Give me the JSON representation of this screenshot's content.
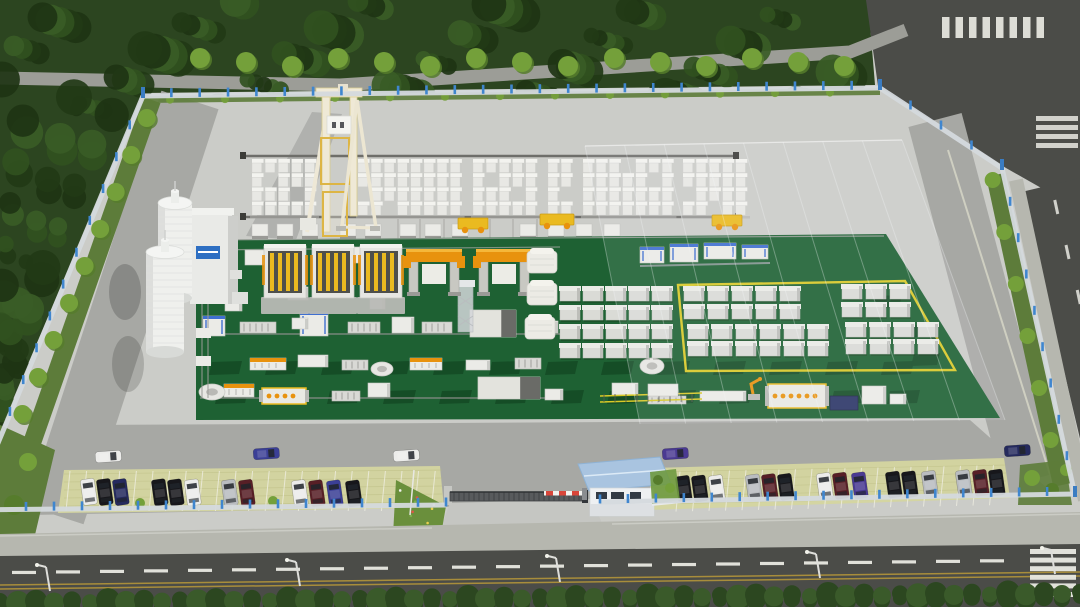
{
  "meta": {
    "scene_title": "Aerial 3D rendering of a precast concrete block factory compound",
    "view": "isometric aerial render",
    "image_size": "1080x607"
  },
  "palette": {
    "forest_base": "#2c4520",
    "canopy_1": "#223a16",
    "canopy_2": "#31511f",
    "canopy_3": "#3a5c26",
    "canopy_4": "#1e3413",
    "tree_bright": "#74a03a",
    "tree_dark": "#567c2c",
    "grass": "#5d7c3a",
    "path": "#9c9d97",
    "asphalt": "#4b4c48",
    "sidewalk": "#b6b7af",
    "pavement": "#cbccc8",
    "pavement_dark": "#a7a8a4",
    "driveway": "#c5c6c2",
    "green_floor": "#1e6133",
    "green_pit": "#154c26",
    "floor_yellow": "#d9c926",
    "fence_panel": "#d5dade",
    "fence_post": "#3f86cf",
    "block_white": "#e8e8e4",
    "block_top": "#f3f3ef",
    "block_shade": "#c3c4c0",
    "machine_white": "#ebebe7",
    "machine_gray": "#b8b9b5",
    "machine_dark": "#4e4f4b",
    "machine_orange": "#e8920e",
    "machine_yellow": "#eaba20",
    "machine_blue": "#3f6fd0",
    "navy_box": "#2b3566",
    "crane_cream": "#eee8d6",
    "crane_yellow": "#ddb544",
    "silo_white": "#eff0ed",
    "silo_shade": "#d8dad7",
    "sign_blue": "#2e6fc2",
    "roof_blue": "#a9c4e0",
    "house_wall": "#eef0f2",
    "paving_yellow": "#d4d5a0",
    "paving_grid": "#b8b97e",
    "hedge_1": "#2c4720",
    "hedge_2": "#3a5a2a",
    "marking_white": "#e9e9e3",
    "marking_yellow": "#b2953a",
    "car_white": "#ececea",
    "car_black": "#17171b",
    "car_silver": "#b9bcc0",
    "car_darkred": "#571f26",
    "car_blue": "#3b3f96",
    "car_navy": "#252a5e",
    "car_purple": "#4a3a92"
  },
  "labels": {
    "surroundings": "Dense tree belt on north and west, service path behind trees, road intersection with zebra crossings at top right, street along east fence, four-lane street with dashed lane line and double yellow centerline along the south, clipped hedge row at bottom edge",
    "compound": "Walled compound with light panel fence on blue posts, concrete hardstanding, block storage yard under a beige gantry crane, two white silos with batching building, dark-green coated production floor with casting machines, demolding gantries, conveyor lines and pallet stacks, translucent warehouse outline over the east half, yellow painted floor marking, grass-grid parking along the south fence, sliding entrance gate with boom barrier and blue-roofed guard house"
  },
  "inventory": {
    "silos": 2,
    "casting_machines": 3,
    "demolding_gantries": 2,
    "curing_tents": 3,
    "block_storage_clusters": 6,
    "pallet_stack_groups": 5,
    "transfer_carts": 3,
    "conveyor_lines": 3,
    "robot_arms": 1,
    "street_lamps": 5,
    "moving_cars": 5,
    "parked_cars": 27,
    "guard_houses": 1
  },
  "block_clusters": [
    {
      "x": 252,
      "cols": 5
    },
    {
      "x": 358,
      "cols": 8
    },
    {
      "x": 473,
      "cols": 5
    },
    {
      "x": 548,
      "cols": 2
    },
    {
      "x": 583,
      "cols": 7
    },
    {
      "x": 683,
      "cols": 5
    }
  ],
  "pallet_groups": [
    {
      "x0": 560,
      "y0": 288,
      "cols": 5,
      "rows": 4,
      "dx": 23,
      "dy": 19
    },
    {
      "x0": 684,
      "y0": 288,
      "cols": 5,
      "rows": 2,
      "dx": 24,
      "dy": 18
    },
    {
      "x0": 842,
      "y0": 286,
      "cols": 3,
      "rows": 2,
      "dx": 24,
      "dy": 18
    },
    {
      "x0": 688,
      "y0": 326,
      "cols": 6,
      "rows": 2,
      "dx": 24,
      "dy": 17
    },
    {
      "x0": 846,
      "y0": 324,
      "cols": 4,
      "rows": 2,
      "dx": 24,
      "dy": 17
    }
  ],
  "curing_tents": [
    {
      "x": 527,
      "y": 251
    },
    {
      "x": 527,
      "y": 283
    },
    {
      "x": 525,
      "y": 317
    }
  ],
  "vehicles": {
    "moving": [
      {
        "x": 95,
        "y": 452,
        "c": "white"
      },
      {
        "x": 253,
        "y": 449,
        "c": "blue"
      },
      {
        "x": 393,
        "y": 451,
        "c": "white"
      },
      {
        "x": 662,
        "y": 449,
        "c": "purple"
      },
      {
        "x": 1004,
        "y": 446,
        "c": "navy"
      }
    ],
    "parked_left": [
      {
        "x": 87,
        "c": "white"
      },
      {
        "x": 103,
        "c": "black"
      },
      {
        "x": 119,
        "c": "navy"
      },
      {
        "x": 158,
        "c": "black"
      },
      {
        "x": 174,
        "c": "black"
      },
      {
        "x": 191,
        "c": "white"
      },
      {
        "x": 228,
        "c": "silver"
      },
      {
        "x": 245,
        "c": "darkred"
      },
      {
        "x": 298,
        "c": "white"
      },
      {
        "x": 315,
        "c": "darkred"
      },
      {
        "x": 333,
        "c": "blue"
      },
      {
        "x": 352,
        "c": "black"
      }
    ],
    "parked_right": [
      {
        "x": 682,
        "c": "black"
      },
      {
        "x": 698,
        "c": "black"
      },
      {
        "x": 715,
        "c": "white"
      },
      {
        "x": 752,
        "c": "silver"
      },
      {
        "x": 768,
        "c": "darkred"
      },
      {
        "x": 784,
        "c": "black"
      },
      {
        "x": 823,
        "c": "white"
      },
      {
        "x": 839,
        "c": "darkred"
      },
      {
        "x": 858,
        "c": "purple"
      },
      {
        "x": 892,
        "c": "black"
      },
      {
        "x": 908,
        "c": "black"
      },
      {
        "x": 928,
        "c": "silver"
      },
      {
        "x": 962,
        "c": "silver"
      },
      {
        "x": 979,
        "c": "darkred"
      },
      {
        "x": 995,
        "c": "black"
      }
    ]
  }
}
